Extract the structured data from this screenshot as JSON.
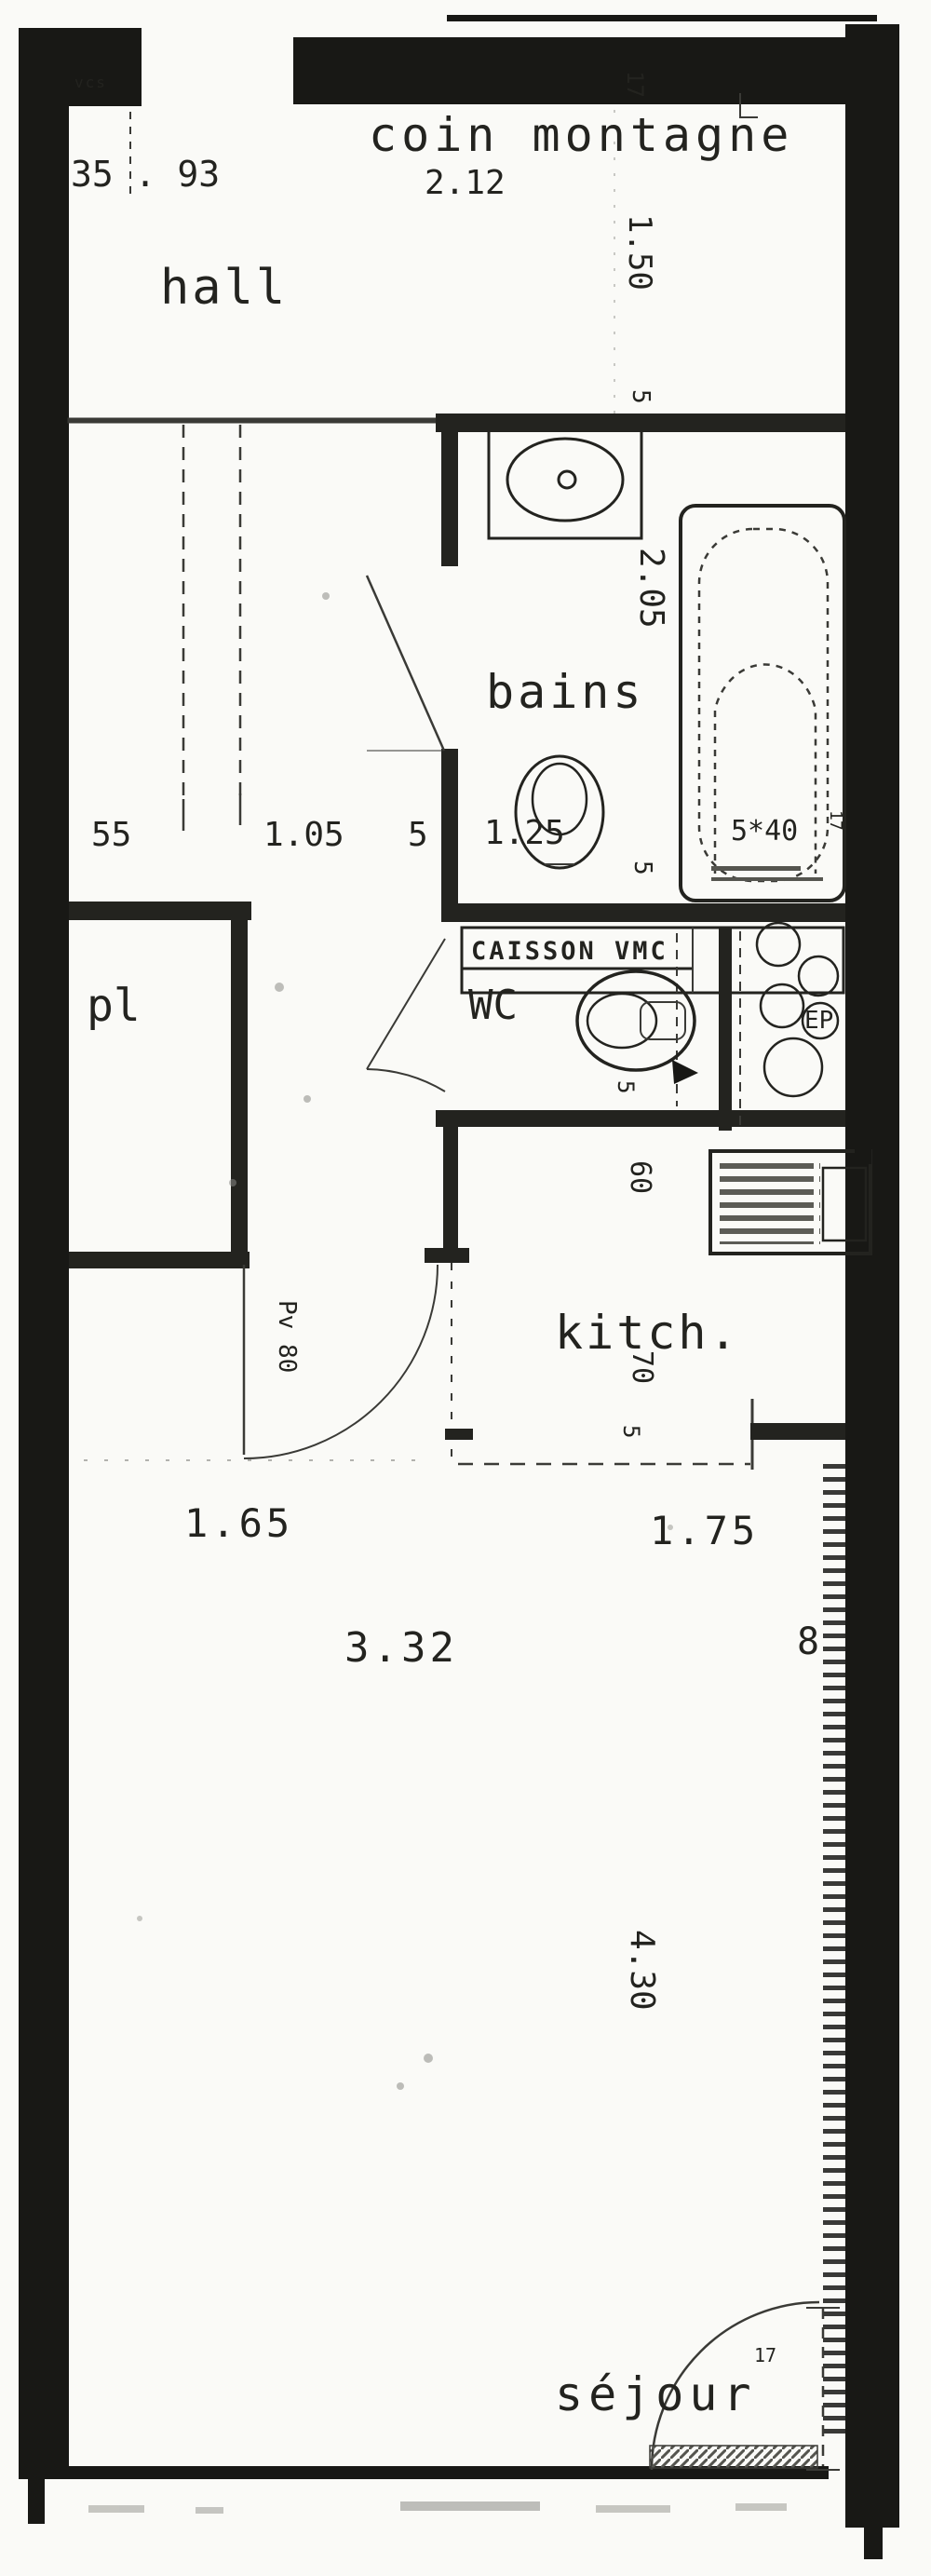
{
  "document": {
    "type": "scanned-floor-plan",
    "language": "fr"
  },
  "colors": {
    "ink": "#181815",
    "paper": "#fafaf7",
    "faint_line": "#3a3a36"
  },
  "texts": {
    "vcs": "vcs",
    "dim_35_93": "35 . 93",
    "hall": "hall",
    "coin_montagne": "coin montagne",
    "dim_2_12": "2.12",
    "dim_17_top": "17",
    "dim_1_50": "1.50",
    "dim_5_bains_top": "5",
    "dim_2_05": "2.05",
    "bains": "bains",
    "dim_55": "55",
    "dim_1_05": "1.05",
    "dim_5_mid": "5",
    "dim_1_25": "1.25",
    "dim_5x40": "5*40",
    "dim_17_tub": "17",
    "dim_5_bains_bottom": "5",
    "caisson_vmc": "CAISSON VMC",
    "wc": "WC",
    "ep": "EP",
    "pl": "pl",
    "dim_5_wc": "5",
    "dim_60": "60",
    "kitch": "kitch.",
    "dim_70": "70",
    "dim_5_kitchen": "5",
    "door_pv_80": "Pv 80",
    "dim_1_65": "1.65",
    "dim_1_75": "1.75",
    "dim_3_32": "3.32",
    "dim_8": "8",
    "dim_4_30": "4.30",
    "sejour": "séjour",
    "dim_17_balcony": "17"
  }
}
